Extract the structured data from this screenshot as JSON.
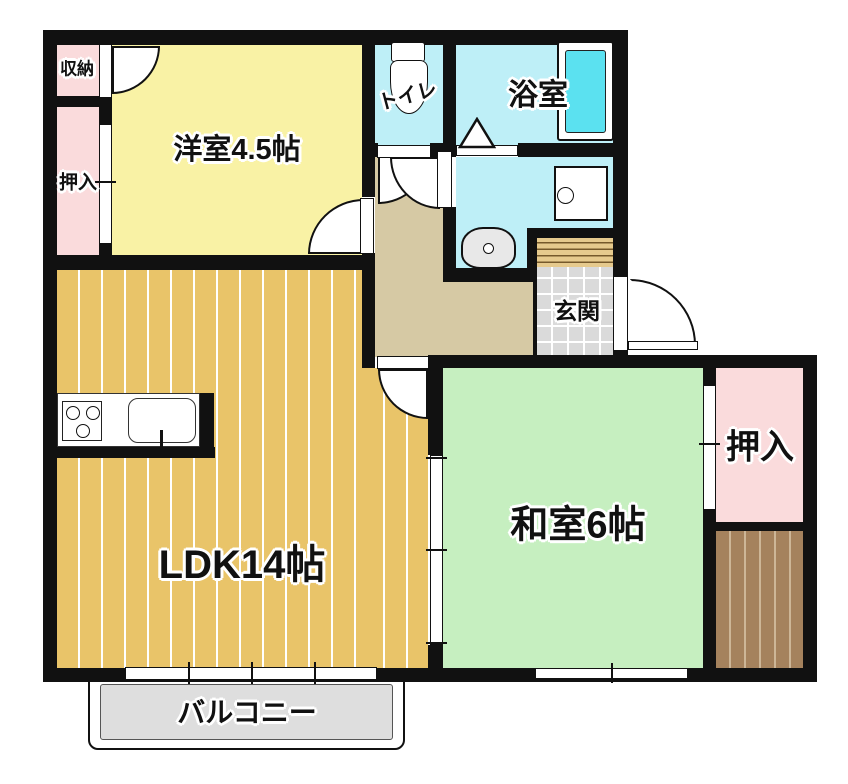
{
  "rooms": {
    "storage": "収納",
    "closet_left": "押入",
    "western_room": "洋室4.5帖",
    "toilet": "トイレ",
    "bathroom": "浴室",
    "entrance": "玄関",
    "ldk": "LDK14帖",
    "japanese_room": "和室6帖",
    "closet_right": "押入",
    "balcony": "バルコニー"
  },
  "fixtures": {
    "toilet": "toilet-icon",
    "bathtub": "bathtub-icon",
    "washing_machine": "washing-machine-icon",
    "washbasin": "washbasin-icon",
    "stove": "stove-icon",
    "kitchen_sink": "kitchen-sink-icon",
    "folding_door": "folding-door-icon"
  },
  "colors": {
    "wall": "#111111",
    "western_room": "#F9F2A5",
    "ldk": "#E9C469",
    "japanese_room": "#C6EFC0",
    "closet": "#FADBDC",
    "wet_rooms": "#BEEFF7",
    "bathtub": "#5BE1F0",
    "hallway": "#D6C9A4",
    "entrance_tile": "#DADADA",
    "shoe_cabinet": "#E6CA8D",
    "deck": "#A5825D",
    "balcony": "#DEDEDE"
  }
}
